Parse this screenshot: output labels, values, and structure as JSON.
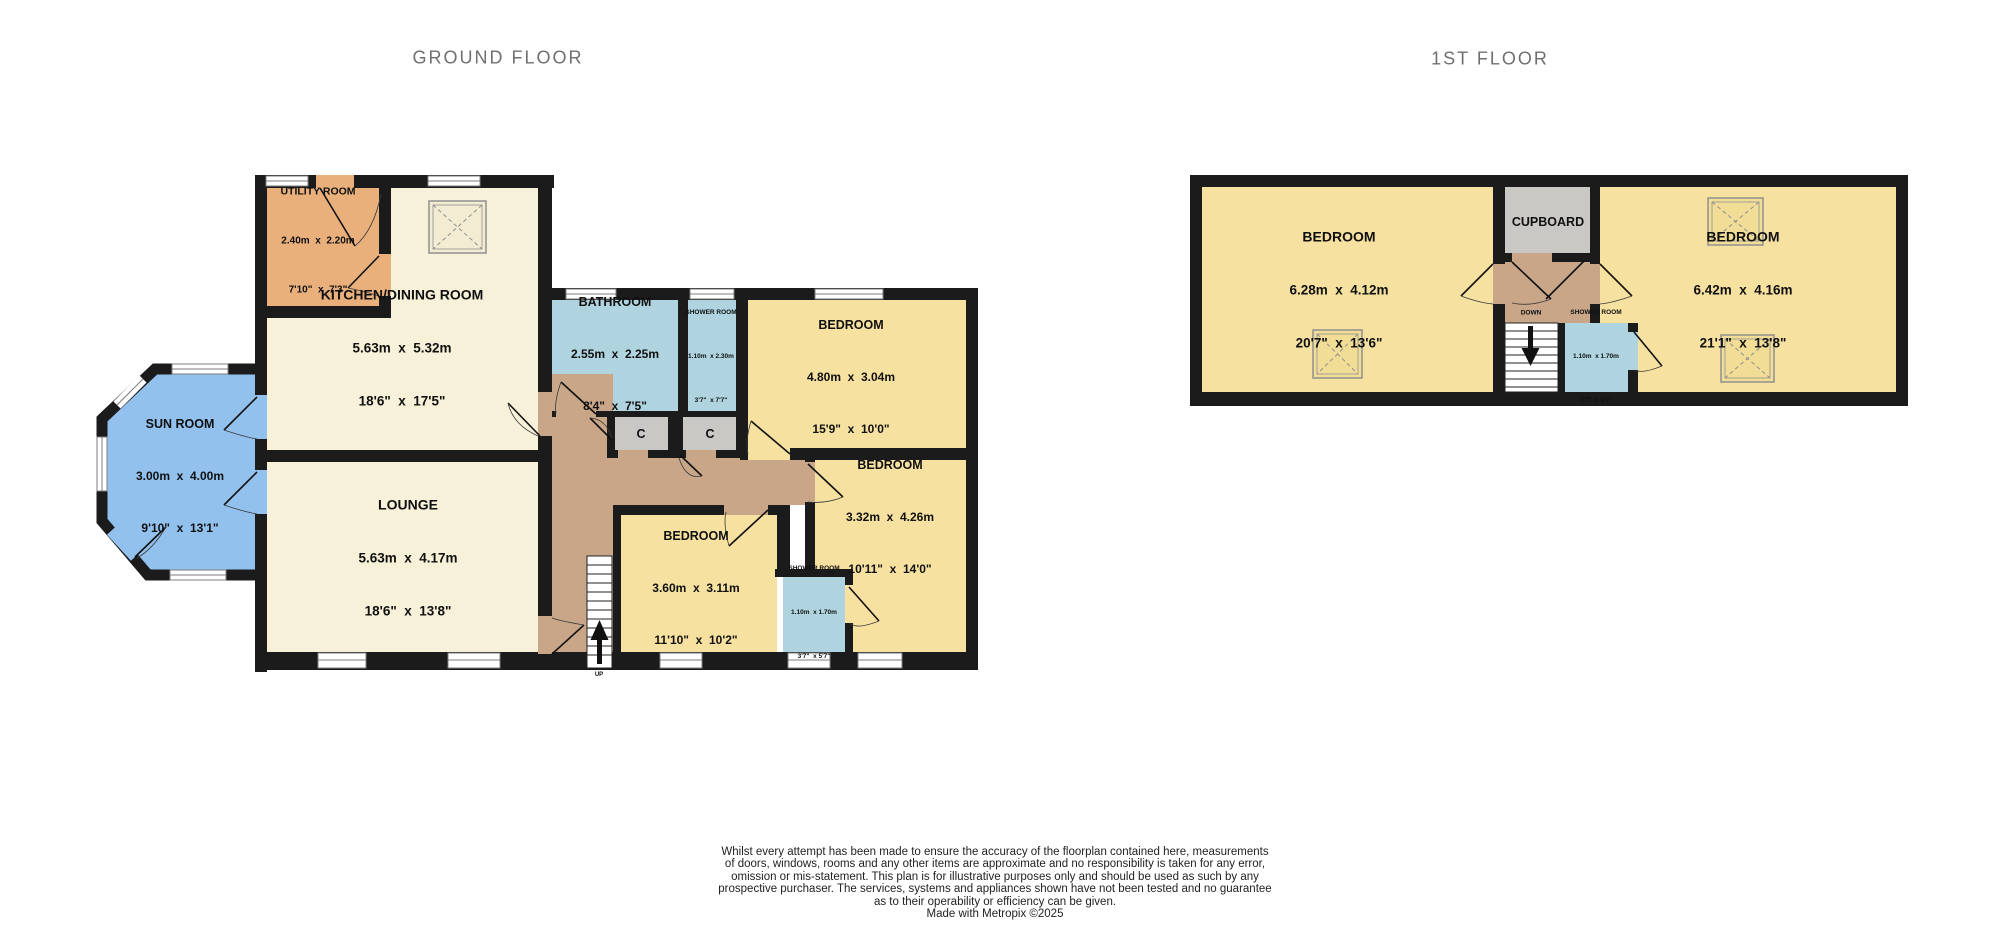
{
  "titles": {
    "ground": "GROUND FLOOR",
    "first": "1ST FLOOR"
  },
  "ground": {
    "rooms": {
      "utility": {
        "name": "UTILITY ROOM",
        "metric": "2.40m  x  2.20m",
        "imperial": "7'10\"  x  7'3\""
      },
      "kitchen": {
        "name": "KITCHEN/DINING ROOM",
        "metric": "5.63m  x  5.32m",
        "imperial": "18'6\"  x  17'5\""
      },
      "sun_room": {
        "name": "SUN ROOM",
        "metric": "3.00m  x  4.00m",
        "imperial": "9'10\"  x  13'1\""
      },
      "lounge": {
        "name": "LOUNGE",
        "metric": "5.63m  x  4.17m",
        "imperial": "18'6\"  x  13'8\""
      },
      "bathroom": {
        "name": "BATHROOM",
        "metric": "2.55m  x  2.25m",
        "imperial": "8'4\"  x  7'5\""
      },
      "shower_top": {
        "name": "SHOWER ROOM",
        "metric": "1.10m  x 2.30m",
        "imperial": "3'7\"  x 7'7\""
      },
      "bedroom_1": {
        "name": "BEDROOM",
        "metric": "4.80m  x  3.04m",
        "imperial": "15'9\"  x  10'0\""
      },
      "bedroom_2": {
        "name": "BEDROOM",
        "metric": "3.32m  x  4.26m",
        "imperial": "10'11\"  x  14'0\""
      },
      "bedroom_3": {
        "name": "BEDROOM",
        "metric": "3.60m  x  3.11m",
        "imperial": "11'10\"  x  10'2\""
      },
      "shower_bottom": {
        "name": "SHOWER ROOM",
        "metric": "1.10m  x 1.70m",
        "imperial": "3'7\"  x 5'7\""
      }
    },
    "labels": {
      "cupboard_abbrev": "C",
      "stairs_up": "UP"
    }
  },
  "first": {
    "rooms": {
      "bedroom_left": {
        "name": "BEDROOM",
        "metric": "6.28m  x  4.12m",
        "imperial": "20'7\"  x  13'6\""
      },
      "bedroom_right": {
        "name": "BEDROOM",
        "metric": "6.42m  x  4.16m",
        "imperial": "21'1\"  x  13'8\""
      },
      "shower_room": {
        "name": "SHOWER ROOM",
        "metric": "1.10m  x 1.70m",
        "imperial": "3'7\"  x 5'7\""
      }
    },
    "labels": {
      "cupboard": "CUPBOARD",
      "stairs_down": "DOWN"
    }
  },
  "disclaimer": {
    "lines": [
      "Whilst every attempt has been made to ensure the accuracy of the floorplan contained here, measurements",
      "of doors, windows, rooms and any other items are approximate and no responsibility is taken for any error,",
      "omission or mis-statement. This plan is for illustrative purposes only and should be used as such by any",
      "prospective purchaser. The services, systems and appliances shown have not been tested and no guarantee",
      "as to their operability or efficiency can be given.",
      "Made with Metropix ©2025"
    ]
  },
  "colors": {
    "wall": "#1b1b1b",
    "room_cream": "#f7f1d9",
    "room_yellow": "#f6e1a0",
    "room_orange": "#e9b07c",
    "room_blue": "#92c1ee",
    "room_lightblue": "#afd4df",
    "hallway_tan": "#c8a687",
    "cupboard_gray": "#c9c8c5",
    "title_gray": "#6f6f6f"
  }
}
